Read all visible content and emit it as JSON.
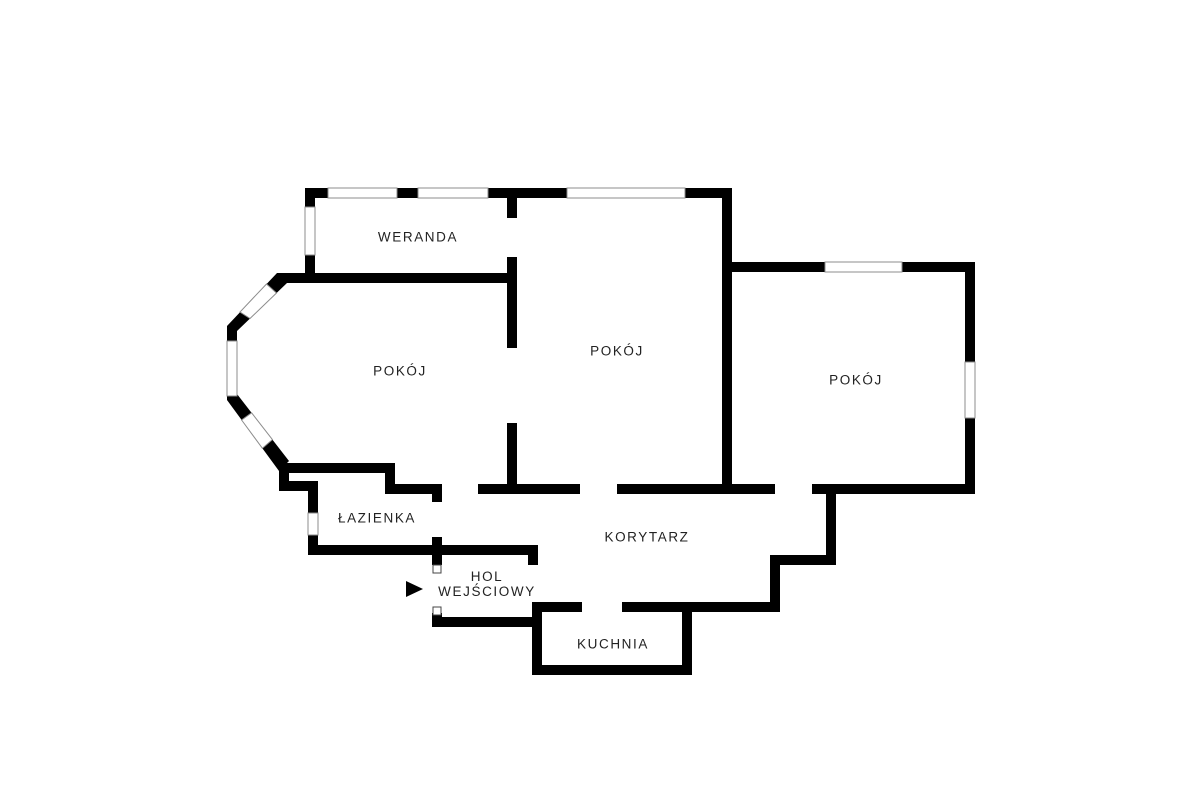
{
  "rooms": {
    "weranda": {
      "label": "WERANDA"
    },
    "pokoj_left": {
      "label": "POKÓJ"
    },
    "pokoj_middle": {
      "label": "POKÓJ"
    },
    "pokoj_right": {
      "label": "POKÓJ"
    },
    "lazienka": {
      "label": "ŁAZIENKA"
    },
    "korytarz": {
      "label": "KORYTARZ"
    },
    "hol": {
      "label_line1": "HOL",
      "label_line2": "WEJŚCIOWY"
    },
    "kuchnia": {
      "label": "KUCHNIA"
    }
  },
  "entrance": {
    "arrow_icon": "right-pointing-triangle"
  },
  "colors": {
    "wall": "#000000",
    "background": "#ffffff",
    "window_stroke": "#8c8c8c",
    "door_marker_stroke": "#444444",
    "text": "#222222"
  }
}
